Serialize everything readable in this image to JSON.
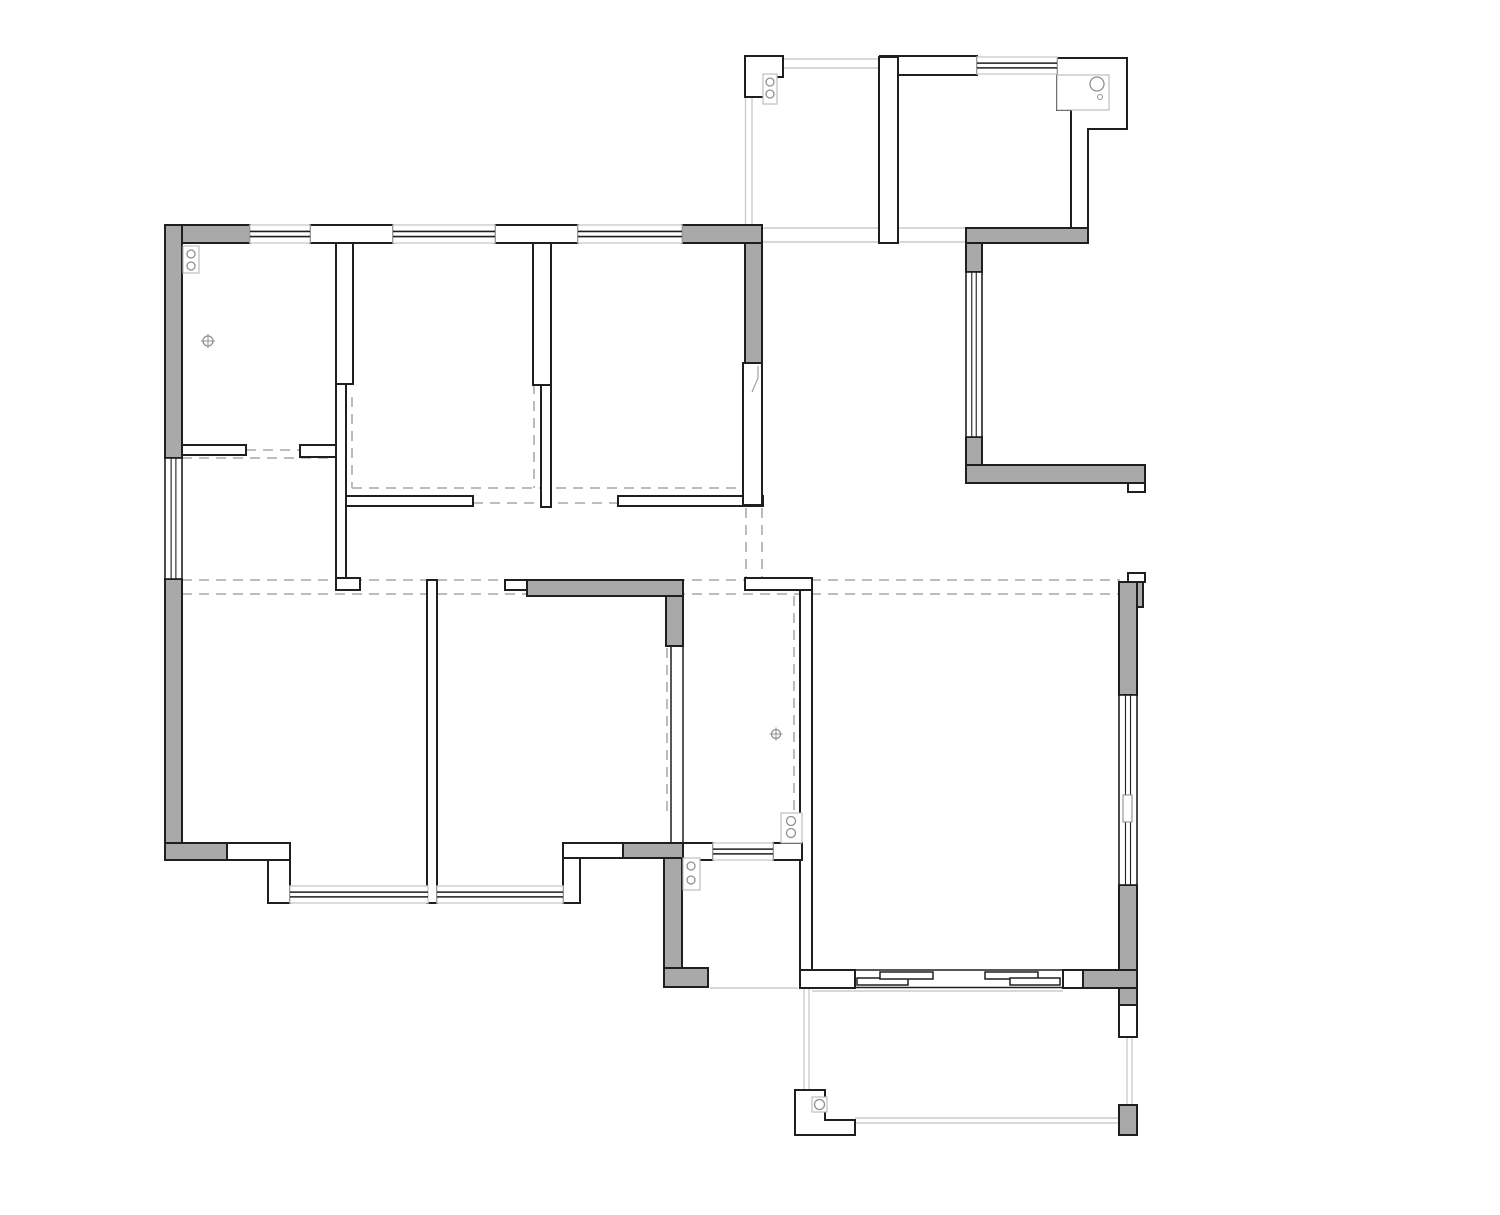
{
  "canvas": {
    "width": 1500,
    "height": 1215,
    "background": "#ffffff"
  },
  "colors": {
    "wall_fill": "#a9a9a9",
    "wall_stroke": "#1f1f1f",
    "white_fill": "#ffffff",
    "light_line": "#cccccc",
    "dash_line": "#b4b4b4",
    "symbol": "#909090",
    "symbol_box": "#b8b8b8",
    "glass": "#1f1f1f"
  },
  "style": {
    "wall_width": 2,
    "thin_wall_width": 1.5,
    "window_border_width": 1.4,
    "glass_width": 1.6,
    "light_width": 1.4,
    "dash_width": 1.8,
    "symbol_width": 1.3,
    "dash_pattern": "10 7"
  },
  "floorplan": {
    "gray_walls": [
      {
        "r": [
          165,
          225,
          85,
          18
        ]
      },
      {
        "r": [
          165,
          225,
          17,
          233
        ]
      },
      {
        "r": [
          682,
          225,
          80,
          18
        ]
      },
      {
        "r": [
          745,
          243,
          17,
          120
        ]
      },
      {
        "r": [
          165,
          579,
          17,
          264
        ]
      },
      {
        "r": [
          165,
          843,
          62,
          17
        ]
      },
      {
        "r": [
          623,
          843,
          60,
          15
        ]
      },
      {
        "r": [
          664,
          858,
          18,
          110
        ]
      },
      {
        "r": [
          664,
          968,
          44,
          19
        ]
      },
      {
        "r": [
          527,
          580,
          156,
          16
        ]
      },
      {
        "r": [
          666,
          596,
          17,
          50
        ]
      },
      {
        "r": [
          966,
          228,
          122,
          15
        ]
      },
      {
        "r": [
          966,
          243,
          16,
          29
        ]
      },
      {
        "r": [
          966,
          437,
          16,
          28
        ]
      },
      {
        "r": [
          966,
          465,
          179,
          18
        ]
      },
      {
        "r": [
          1119,
          582,
          24,
          25
        ]
      },
      {
        "r": [
          1119,
          582,
          18,
          113
        ]
      },
      {
        "r": [
          1119,
          885,
          18,
          120
        ]
      },
      {
        "r": [
          1083,
          970,
          54,
          18
        ]
      },
      {
        "r": [
          1119,
          1105,
          18,
          30
        ]
      }
    ],
    "white_walls": [
      {
        "r": [
          310,
          225,
          83,
          18
        ]
      },
      {
        "r": [
          495,
          225,
          83,
          18
        ]
      },
      {
        "r": [
          336,
          243,
          17,
          141
        ]
      },
      {
        "r": [
          336,
          384,
          10,
          194
        ]
      },
      {
        "r": [
          336,
          578,
          24,
          12
        ]
      },
      {
        "r": [
          182,
          445,
          64,
          10
        ]
      },
      {
        "r": [
          300,
          445,
          36,
          12
        ]
      },
      {
        "r": [
          533,
          243,
          18,
          142
        ]
      },
      {
        "r": [
          541,
          385,
          10,
          122
        ]
      },
      {
        "r": [
          346,
          496,
          127,
          10
        ]
      },
      {
        "r": [
          618,
          496,
          145,
          10
        ]
      },
      {
        "r": [
          743,
          363,
          19,
          142
        ]
      },
      {
        "r": [
          745,
          578,
          67,
          12
        ]
      },
      {
        "r": [
          800,
          590,
          12,
          380
        ]
      },
      {
        "r": [
          800,
          970,
          55,
          18
        ]
      },
      {
        "r": [
          505,
          580,
          23,
          10
        ]
      },
      {
        "r": [
          227,
          843,
          63,
          17
        ]
      },
      {
        "r": [
          268,
          860,
          22,
          43
        ]
      },
      {
        "r": [
          427,
          580,
          10,
          323
        ]
      },
      {
        "r": [
          563,
          843,
          60,
          15
        ]
      },
      {
        "r": [
          563,
          858,
          17,
          45
        ]
      },
      {
        "r": [
          683,
          843,
          30,
          17
        ]
      },
      {
        "r": [
          773,
          843,
          29,
          17
        ]
      },
      {
        "r": [
          1063,
          970,
          20,
          18
        ]
      },
      {
        "r": [
          1119,
          1005,
          18,
          32
        ]
      },
      {
        "r": [
          1128,
          573,
          17,
          9
        ]
      },
      {
        "r": [
          1128,
          483,
          17,
          9
        ]
      },
      {
        "r": [
          880,
          56,
          97,
          19
        ]
      },
      {
        "r": [
          879,
          57,
          19,
          186
        ]
      }
    ],
    "thin_walls": [
      {
        "r": [
          671,
          645,
          12,
          198
        ]
      }
    ],
    "white_polygons": [
      {
        "pts": "745,56 783,56 783,77 765,77 765,97 745,97"
      },
      {
        "pts": "1057,58 1127,58 1127,129 1088,129 1088,228 1071,228 1071,110 1057,110"
      },
      {
        "pts": "795,1090 825,1090 825,1120 855,1120 855,1135 795,1135"
      }
    ],
    "windows_h": [
      {
        "r": [
          250,
          225,
          60,
          18
        ]
      },
      {
        "r": [
          393,
          225,
          102,
          18
        ]
      },
      {
        "r": [
          578,
          225,
          104,
          18
        ]
      },
      {
        "r": [
          977,
          57,
          80,
          17
        ]
      },
      {
        "r": [
          713,
          843,
          60,
          17
        ]
      },
      {
        "r": [
          290,
          886,
          138,
          17
        ]
      },
      {
        "r": [
          437,
          886,
          126,
          17
        ]
      }
    ],
    "windows_v": [
      {
        "r": [
          165,
          458,
          17,
          121
        ]
      },
      {
        "r": [
          966,
          272,
          16,
          165
        ]
      },
      {
        "r": [
          1119,
          695,
          18,
          190
        ],
        "handle": [
          1123,
          795,
          9,
          27
        ]
      }
    ],
    "sliding_door": {
      "tracks": [
        [
          855,
          970,
          1063,
          970
        ],
        [
          855,
          987.5,
          1063,
          987.5
        ]
      ],
      "panels": [
        {
          "r": [
            857,
            978,
            51,
            7
          ]
        },
        {
          "r": [
            880,
            972,
            53,
            7
          ]
        },
        {
          "r": [
            985,
            972,
            53,
            7
          ]
        },
        {
          "r": [
            1010,
            978,
            50,
            7
          ]
        }
      ]
    },
    "light_lines": [
      [
        783,
        59,
        879,
        59
      ],
      [
        783,
        68,
        879,
        68
      ],
      [
        745.5,
        97,
        745.5,
        227
      ],
      [
        752,
        97,
        752,
        227
      ],
      [
        762,
        228,
        966,
        228
      ],
      [
        762,
        242,
        966,
        242
      ],
      [
        710,
        988,
        798,
        988
      ],
      [
        804,
        988,
        804,
        1090
      ],
      [
        809,
        988,
        809,
        1090
      ],
      [
        855,
        1118,
        1127,
        1118
      ],
      [
        855,
        1123,
        1127,
        1123
      ],
      [
        1127,
        1037,
        1127,
        1105
      ],
      [
        1132,
        1037,
        1132,
        1105
      ],
      [
        290,
        901,
        563,
        901
      ],
      [
        812,
        991,
        1063,
        991
      ]
    ],
    "dashed_lines": [
      [
        182,
        580,
        1120,
        580
      ],
      [
        182,
        594,
        1120,
        594
      ],
      [
        246,
        450,
        300,
        450
      ],
      [
        182,
        458,
        337,
        458
      ],
      [
        352,
        397,
        352,
        488
      ],
      [
        534,
        384,
        534,
        488
      ],
      [
        352,
        488,
        743,
        488
      ],
      [
        473,
        503,
        618,
        503
      ],
      [
        746,
        508,
        746,
        578
      ],
      [
        762,
        508,
        762,
        578
      ],
      [
        667,
        648,
        667,
        812
      ],
      [
        794,
        596,
        794,
        812
      ],
      [
        1071,
        76,
        1071,
        108
      ],
      [
        1085,
        76,
        1085,
        108
      ]
    ],
    "hinge_symbols": [
      {
        "box": [
          183,
          246,
          16,
          27
        ],
        "circles": [
          [
            191,
            254
          ],
          [
            191,
            266
          ]
        ],
        "radius": 4
      },
      {
        "box": [
          763,
          74,
          14,
          30
        ],
        "circles": [
          [
            770,
            82
          ],
          [
            770,
            94
          ]
        ],
        "radius": 4
      },
      {
        "box": [
          781,
          813,
          21,
          30
        ],
        "circles": [
          [
            791,
            821
          ],
          [
            791,
            833
          ]
        ],
        "radius": 4.5
      },
      {
        "box": [
          683,
          858,
          17,
          32
        ],
        "circles": [
          [
            691,
            866
          ],
          [
            691,
            880
          ]
        ],
        "radius": 4
      }
    ],
    "target_symbols": [
      {
        "c": [
          208,
          341
        ],
        "radius": 5
      },
      {
        "c": [
          776,
          734
        ],
        "radius": 4.5
      }
    ],
    "circle_boxes": [
      {
        "box": [
          812,
          1097,
          15,
          15
        ],
        "c": [
          819.5,
          1104.5
        ],
        "radius": 5
      }
    ],
    "counter": {
      "box": [
        1057,
        75,
        52,
        35
      ],
      "big_circle": [
        1097,
        84,
        7
      ],
      "small_circle": [
        1100,
        97,
        2.5
      ]
    },
    "break_lines": [
      [
        758,
        366,
        758,
        378
      ],
      [
        758,
        378,
        752,
        392
      ]
    ]
  }
}
